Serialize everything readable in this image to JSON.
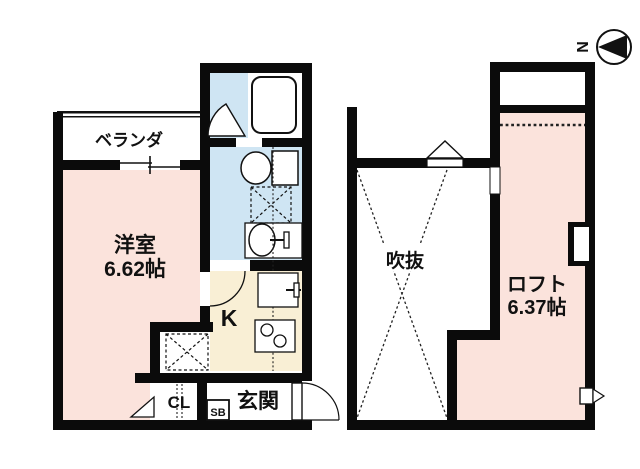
{
  "compass": {
    "north_label": "N"
  },
  "floor1": {
    "veranda_label": "ベランダ",
    "western_room_label": "洋室",
    "western_room_size": "6.62帖",
    "kitchen_label": "K",
    "closet_label": "CL",
    "shoebox_label": "SB",
    "entrance_label": "玄関"
  },
  "floor2": {
    "void_label": "吹抜",
    "loft_label": "ロフト",
    "loft_size": "6.37帖"
  },
  "colors": {
    "wall": "#0b0b0b",
    "room_pink": "#fbe3dc",
    "water_blue": "#cfe5f3",
    "kitchen_cream": "#f9efd5",
    "line": "#111111",
    "white": "#ffffff"
  }
}
